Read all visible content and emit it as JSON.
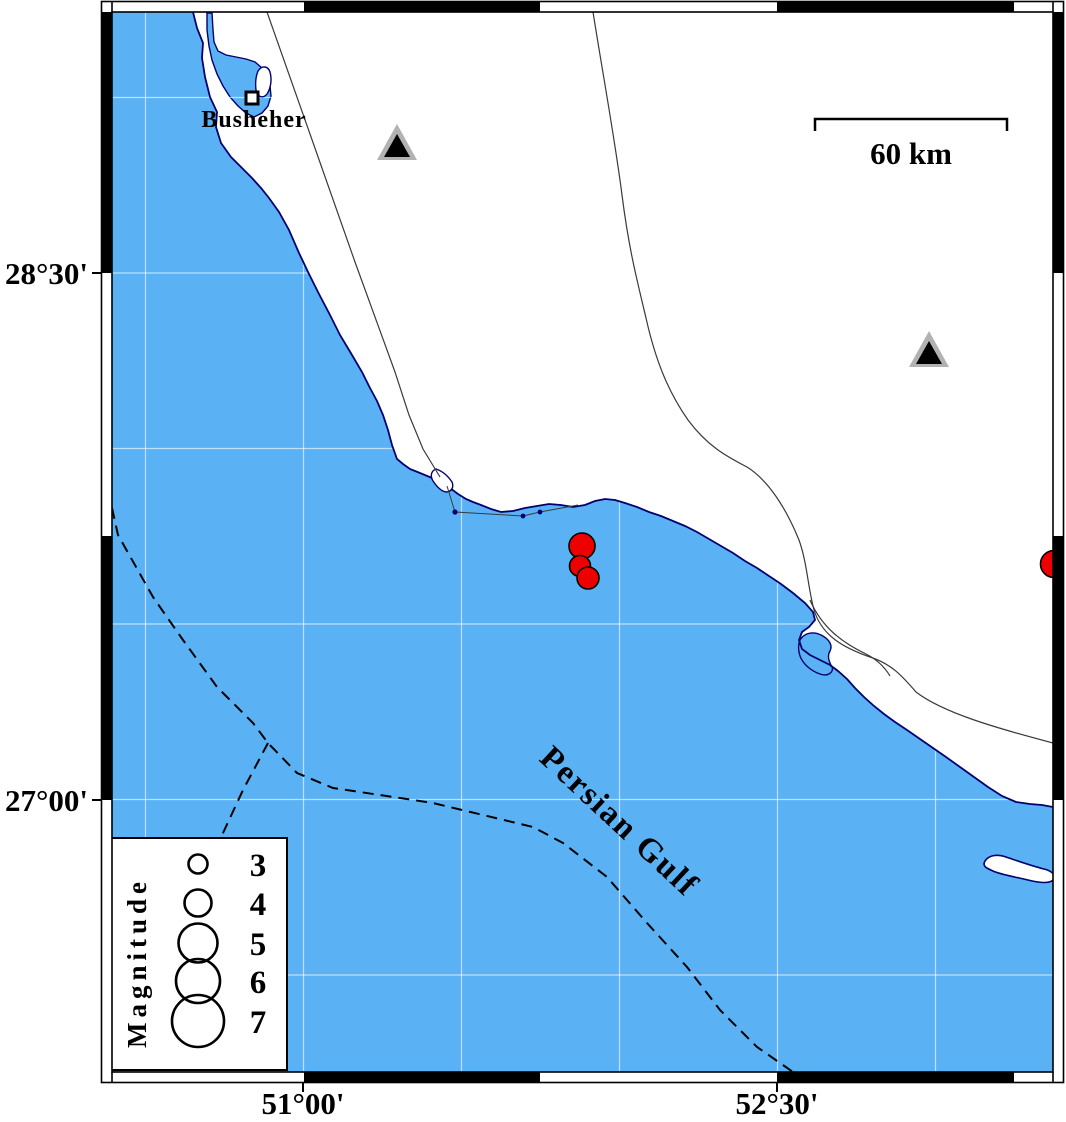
{
  "map_labels": {
    "place": "Busheher",
    "sea_name": "Persian Gulf",
    "scale_label": "60 km",
    "legend_title": "Magnitude"
  },
  "axis": {
    "left": [
      {
        "label": "28°30'",
        "y": 273
      },
      {
        "label": "27°00'",
        "y": 800
      }
    ],
    "bottom": [
      {
        "label": "51°00'",
        "x": 303
      },
      {
        "label": "52°30'",
        "x": 777
      }
    ]
  },
  "legend_entries": [
    {
      "label": "3",
      "cy": 864,
      "r": 9.5
    },
    {
      "label": "4",
      "cy": 903,
      "r": 13.5
    },
    {
      "label": "5",
      "cy": 943,
      "r": 19.5
    },
    {
      "label": "6",
      "cy": 981,
      "r": 22
    },
    {
      "label": "7",
      "cy": 1021,
      "r": 26
    }
  ],
  "events": [
    {
      "x": 582,
      "y": 546,
      "r": 13
    },
    {
      "x": 580,
      "y": 566,
      "r": 10.5
    },
    {
      "x": 588,
      "y": 578,
      "r": 11
    },
    {
      "x": 1054,
      "y": 564,
      "r": 13.5
    }
  ],
  "stations": [
    {
      "x": 397,
      "y": 145
    },
    {
      "x": 929,
      "y": 352
    }
  ],
  "colors": {
    "sea": "#5ab2f4",
    "coast": "#000070",
    "event_fill": "#ee0000",
    "station_outer": "#b2b2b2",
    "station_inner": "#000000"
  }
}
